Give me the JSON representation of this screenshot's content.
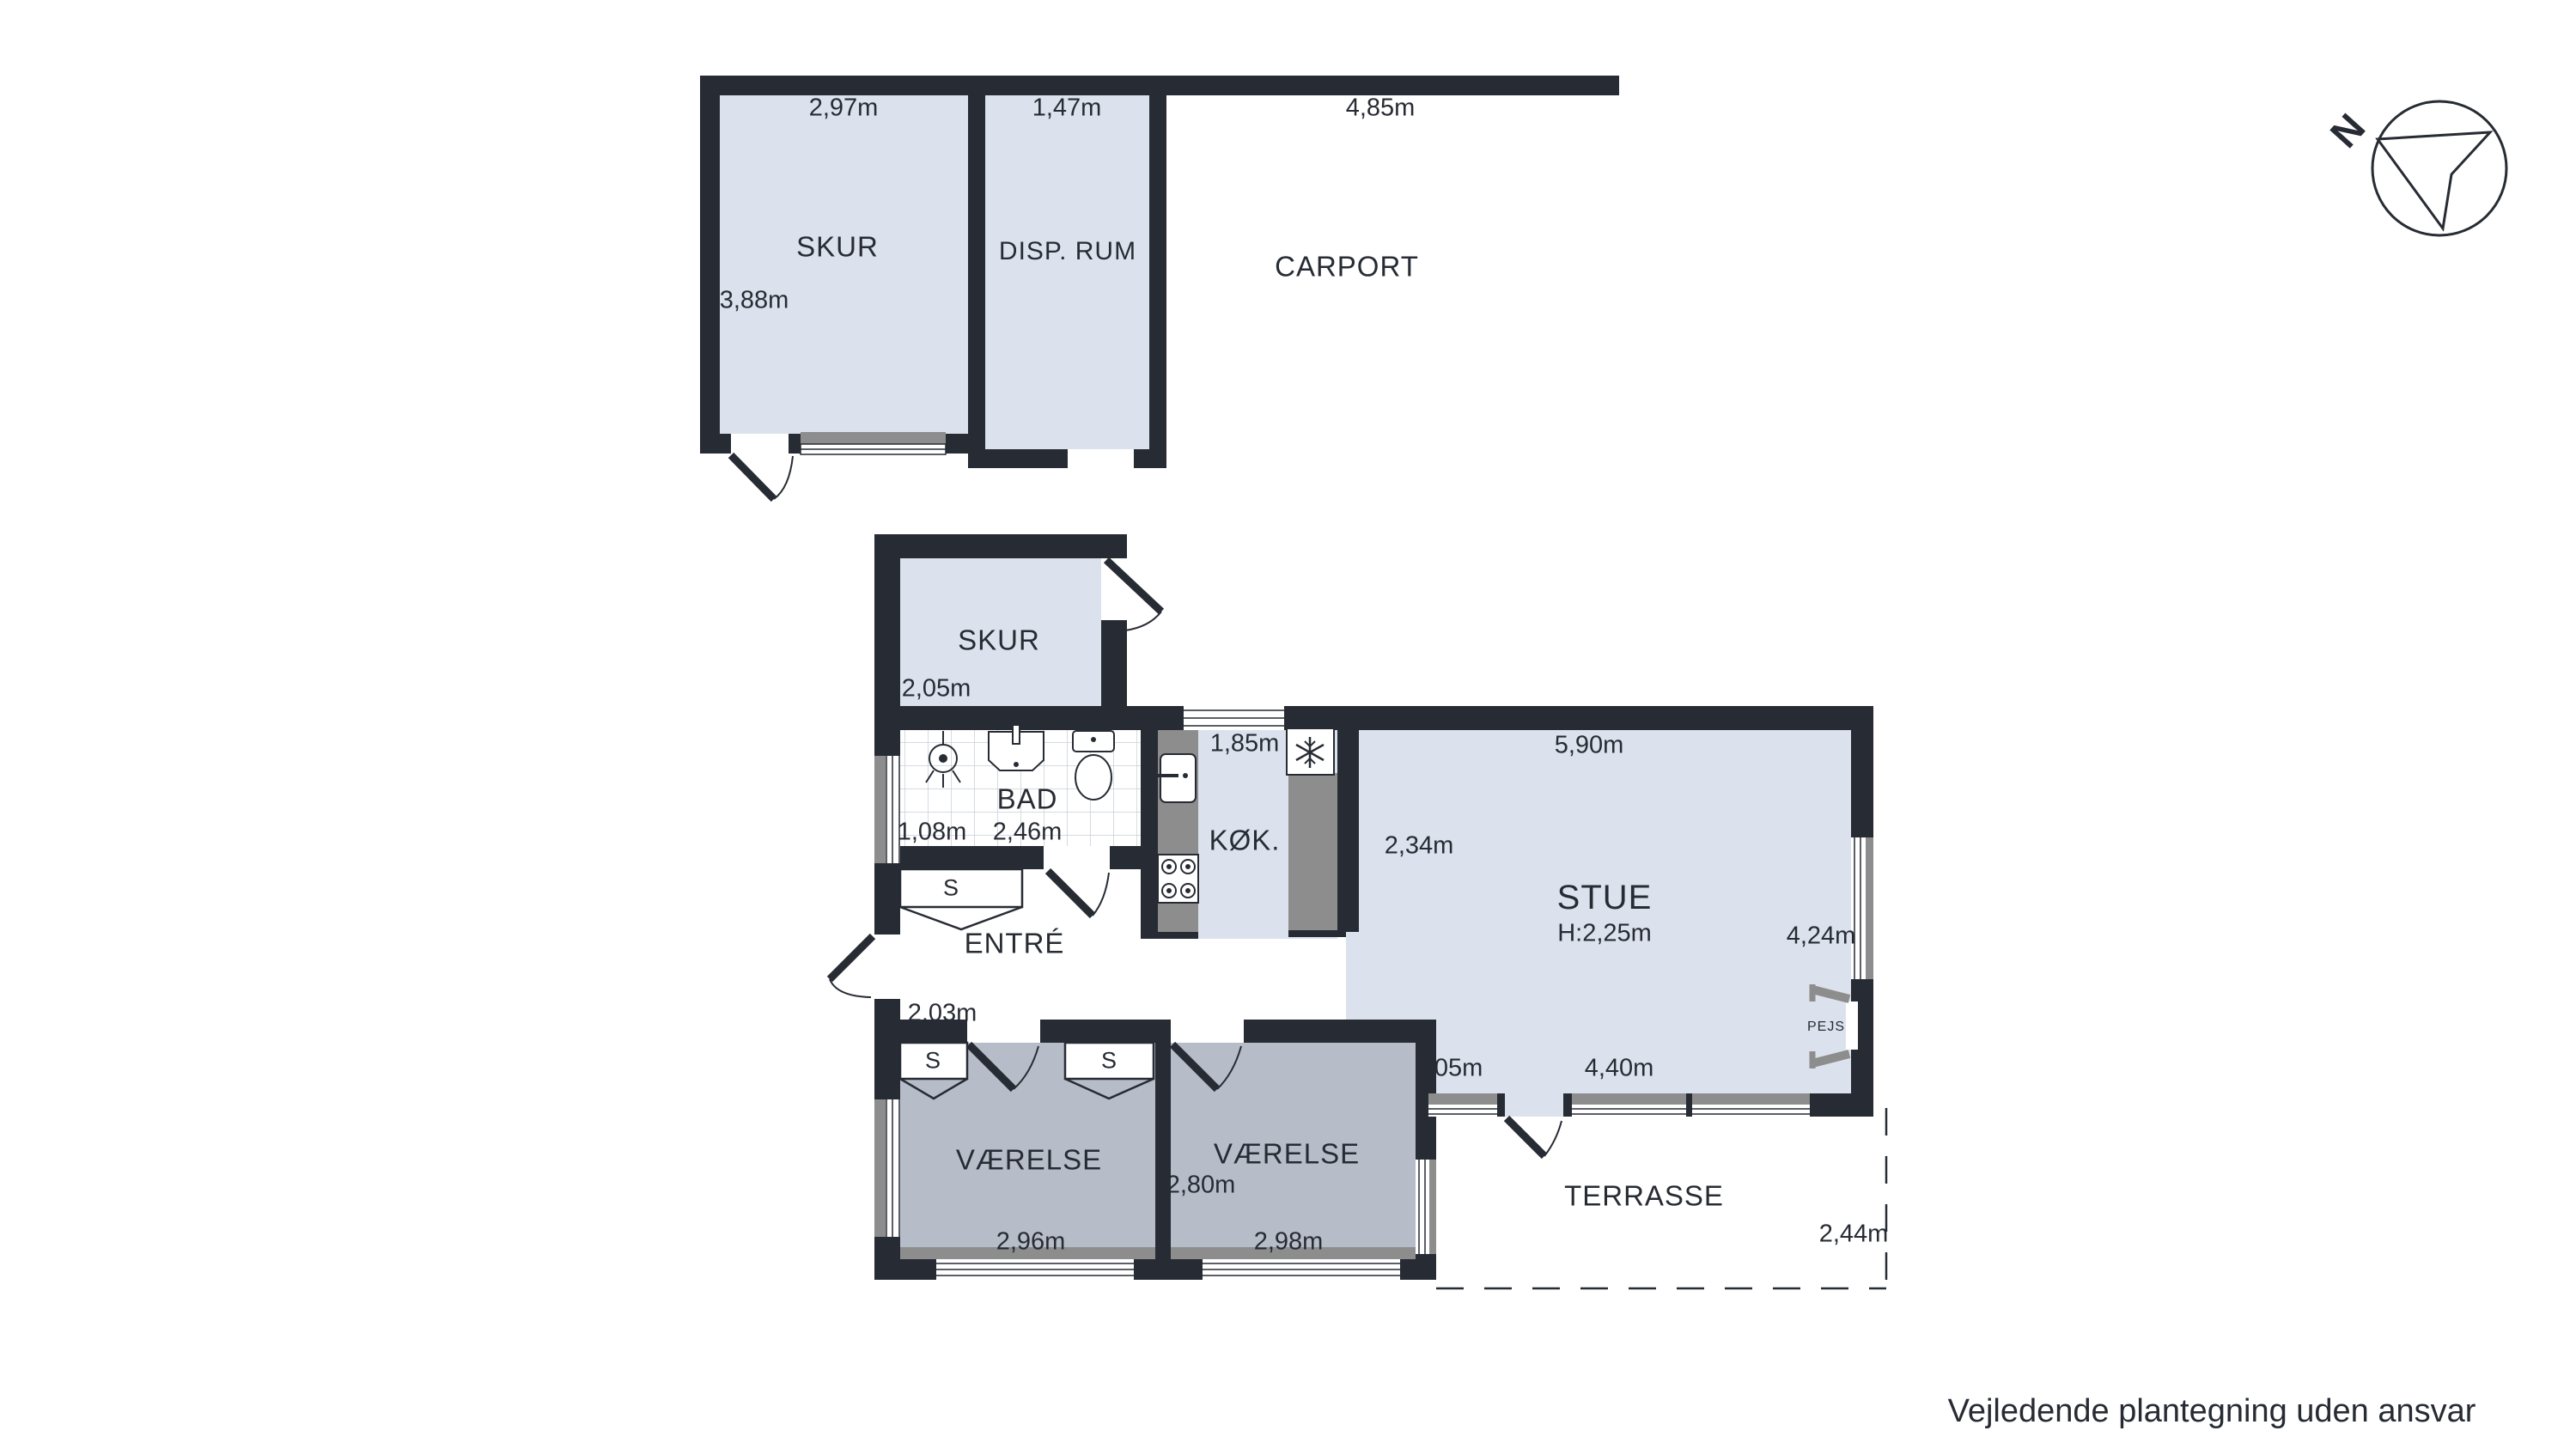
{
  "document": {
    "type": "floor-plan",
    "disclaimer": "Vejledende plantegning uden ansvar"
  },
  "colors": {
    "wall": "#272b33",
    "room_light": "#dce2ed",
    "room_medium": "#b7bcc9",
    "counter_gray": "#8d8d8d",
    "tile_line": "#c9cfd9",
    "text": "#272b33",
    "background": "#ffffff"
  },
  "compass": {
    "label": "N"
  },
  "outbuilding": {
    "skur": {
      "name": "SKUR",
      "width": "2,97m",
      "height": "3,88m"
    },
    "disp_rum": {
      "name": "DISP. RUM",
      "width": "1,47m"
    },
    "carport": {
      "name": "CARPORT",
      "width": "4,85m"
    }
  },
  "house": {
    "skur": {
      "name": "SKUR",
      "width": "2,05m"
    },
    "bad": {
      "name": "BAD",
      "dim_left": "1,08m",
      "dim_right": "2,46m"
    },
    "kok": {
      "name": "KØK.",
      "width": "1,85m"
    },
    "stue": {
      "name": "STUE",
      "ceiling_height": "H:2,25m",
      "dim_top": "5,90m",
      "dim_left": "2,34m",
      "dim_right": "4,24m",
      "dim_bottom_left": "1,05m",
      "dim_bottom": "4,40m",
      "fireplace": "PEJS"
    },
    "entre": {
      "name": "ENTRÉ",
      "width": "2,03m",
      "closet": "S"
    },
    "vaerelse1": {
      "name": "VÆRELSE",
      "width": "2,96m",
      "closet": "S",
      "closet2": "S"
    },
    "vaerelse2": {
      "name": "VÆRELSE",
      "width": "2,98m",
      "height": "2,80m"
    },
    "terrasse": {
      "name": "TERRASSE",
      "width": "2,44m"
    }
  }
}
